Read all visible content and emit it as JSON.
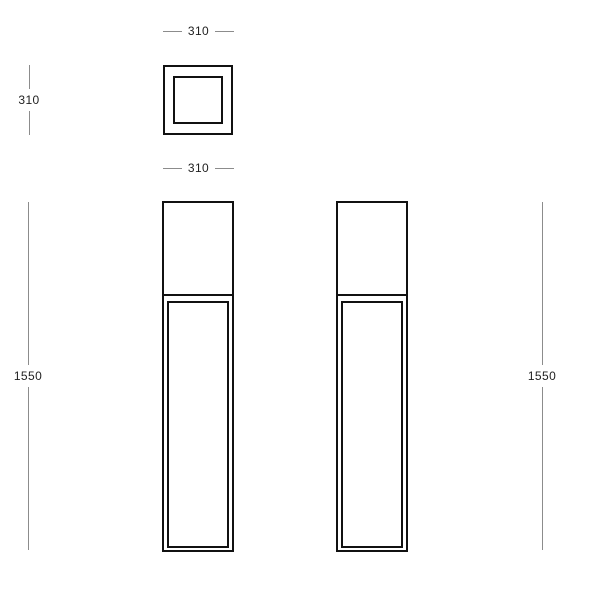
{
  "drawing": {
    "views": {
      "top": {
        "width_dim_top": "310",
        "height_dim_left": "310",
        "width_dim_bottom": "310"
      },
      "front": {
        "height_dim": "1550"
      },
      "side": {
        "height_dim": "1550"
      }
    },
    "colors": {
      "outline": "#111111",
      "dimension_line": "#8c8c8c",
      "dimension_text": "#1f1f1f",
      "background": "#ffffff"
    }
  }
}
